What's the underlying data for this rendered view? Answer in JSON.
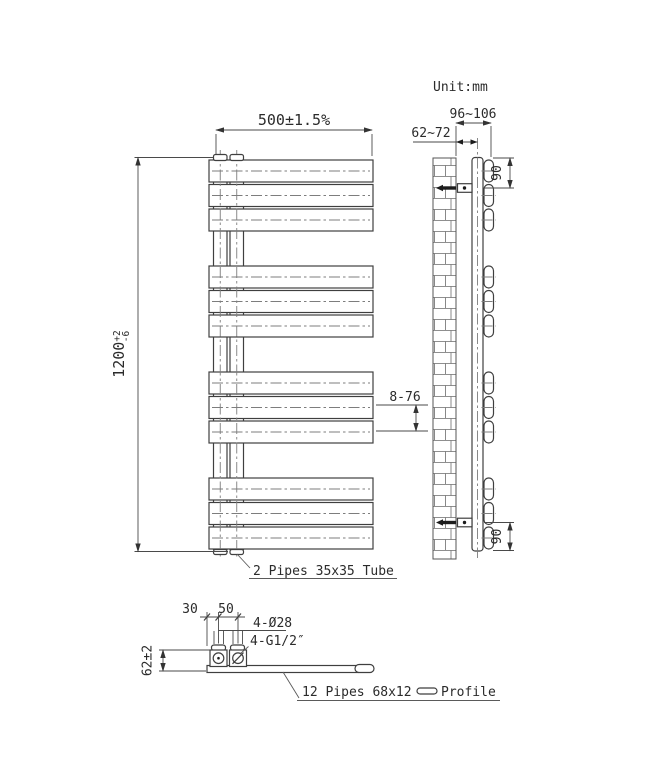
{
  "unit_label": "Unit:mm",
  "front_view": {
    "width_dim": "500±1.5%",
    "height_dim": {
      "value": "1200",
      "tol_plus": "+2",
      "tol_minus": "-6"
    },
    "panel_spacing_dim": "8-76",
    "tube_label": "2 Pipes 35x35 Tube"
  },
  "side_view": {
    "wall_to_front_dim": "96~106",
    "wall_to_tube_center_dim": "62~72",
    "top_bracket_offset_dim": "90",
    "bottom_bracket_offset_dim": "90"
  },
  "bottom_view": {
    "end_to_tube_dim": "30",
    "tube_spacing_dim": "50",
    "holes_dim": "4-Ø28",
    "thread_dim": "4-G1/2″",
    "height_dim": "62±2",
    "profile_label_prefix": "12 Pipes 68x12",
    "profile_label_suffix": "Profile"
  },
  "colors": {
    "line": "#3f3f3f",
    "centerline": "#7d7d7d",
    "text": "#2b2b2b",
    "background": "#ffffff"
  }
}
